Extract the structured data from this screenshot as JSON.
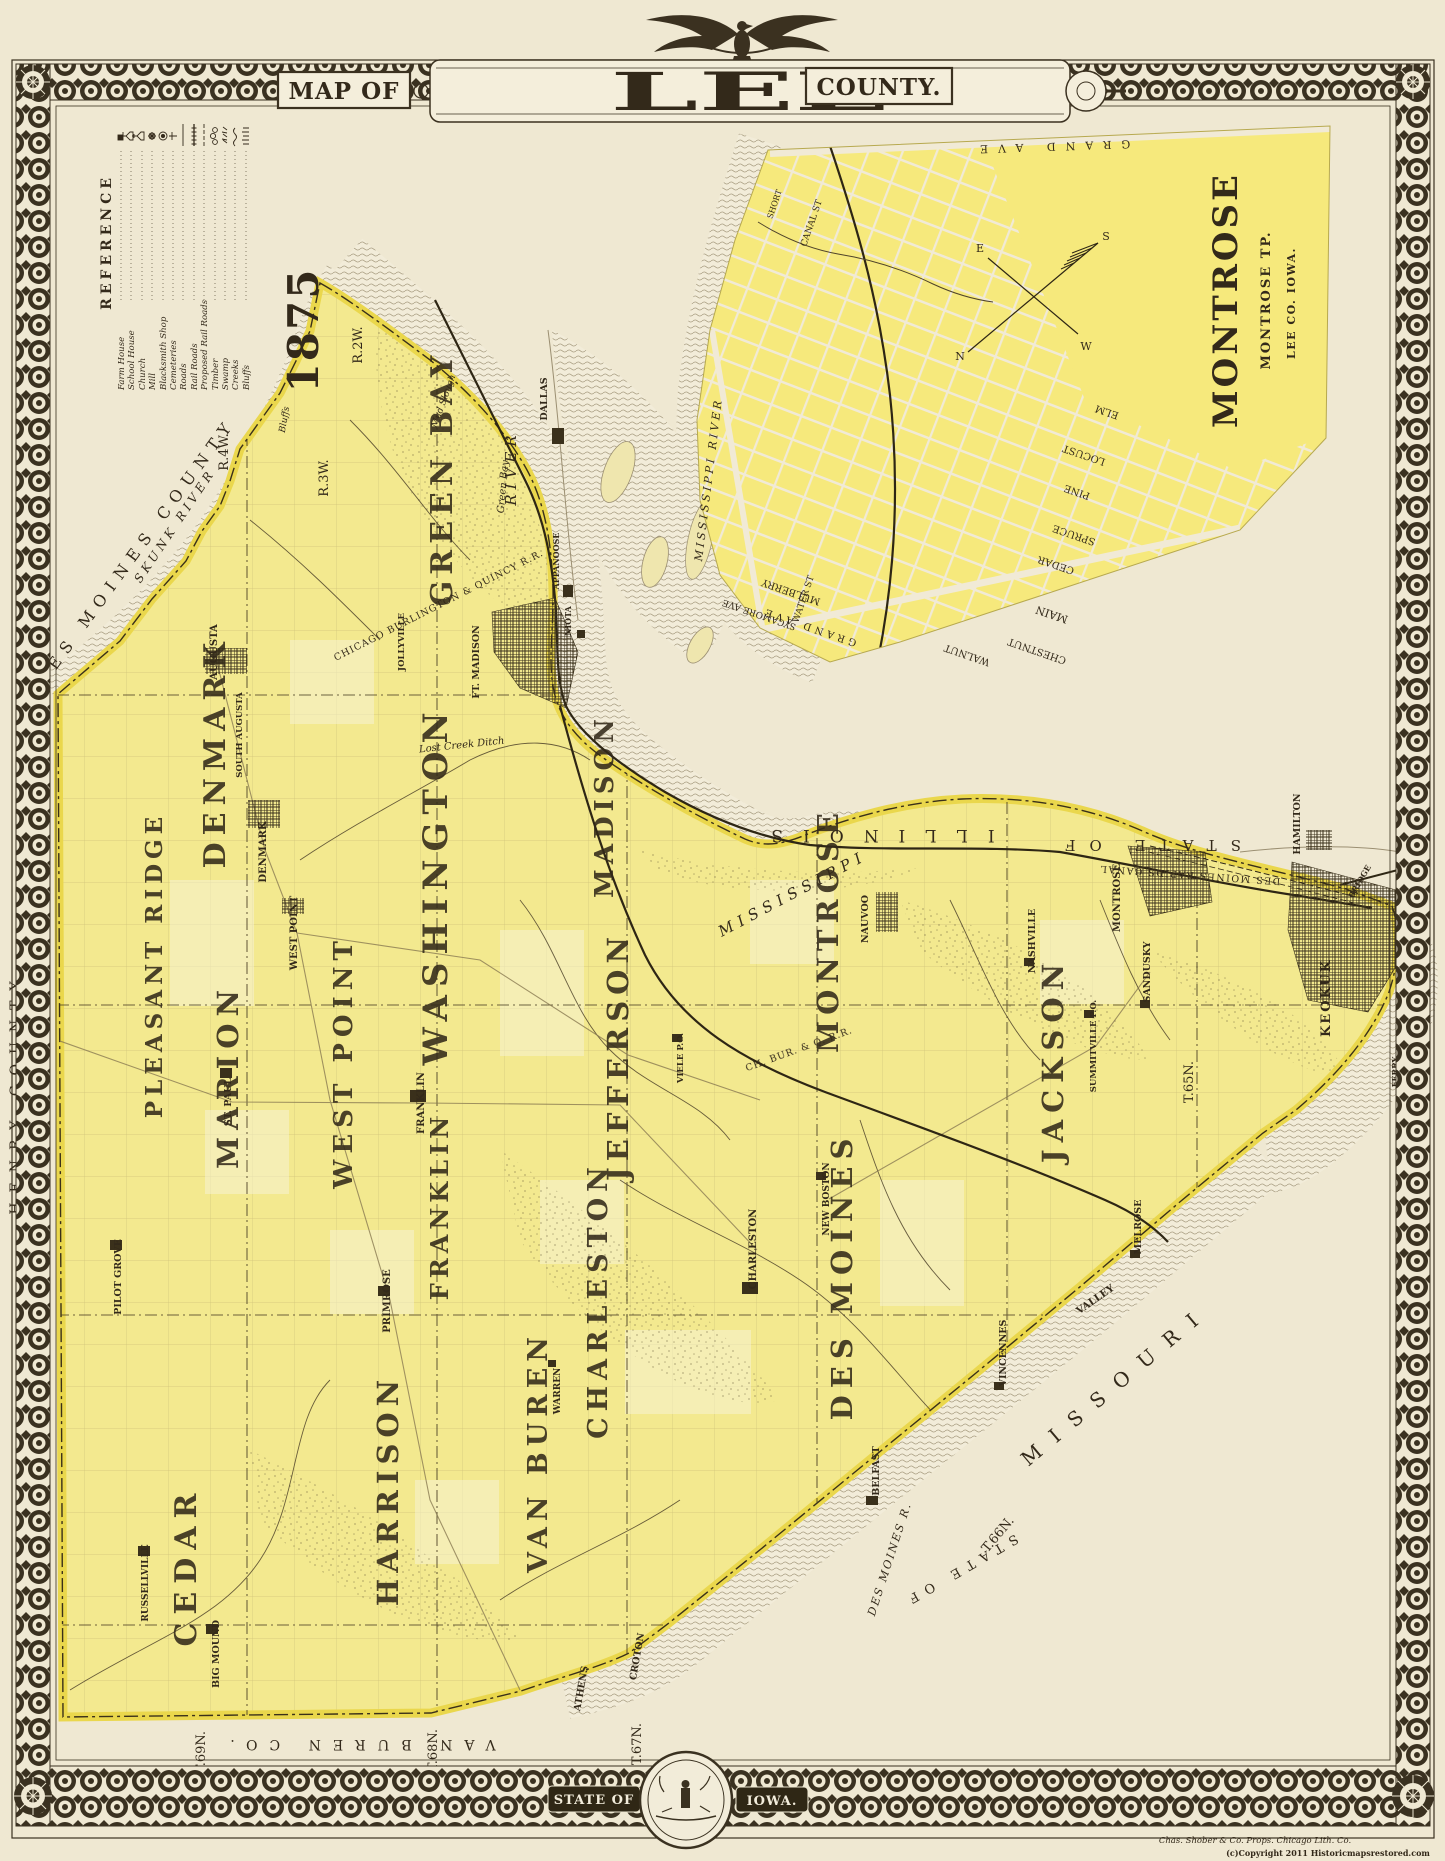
{
  "colors": {
    "paper": "#efe8d2",
    "county_yellow": "#f3e98f",
    "edge_yellow": "#ead74c",
    "inset_yellow": "#f6e97c",
    "ink": "#362d1b",
    "river_line": "#9b8f72"
  },
  "title": {
    "prefix": "MAP OF",
    "name": "LEE",
    "suffix": "COUNTY.",
    "year": "1875"
  },
  "reference": {
    "title": "REFERENCE",
    "items": [
      "Farm House",
      "School House",
      "Church",
      "Mill",
      "Blacksmith Shop",
      "Cemeteries",
      "Roads",
      "Rail Roads",
      "Proposed Rail Roads",
      "Timber",
      "Swamp",
      "Creeks",
      "Bluffs"
    ]
  },
  "inset": {
    "title": "MONTROSE",
    "tp": "MONTROSE TP.",
    "co": "LEE CO. IOWA.",
    "river": "MISSISSIPPI RIVER",
    "compass": {
      "n": "N",
      "s": "S",
      "e": "E",
      "w": "W"
    },
    "streets": [
      "GRAND AVE",
      "GRAND AVE",
      "ELM",
      "LOCUST",
      "PINE",
      "SPRUCE",
      "CEDAR",
      "MAIN",
      "CHESTNUT",
      "WALNUT",
      "MULBERRY",
      "SYCAMORE AVE",
      "WATER ST",
      "CANAL ST",
      "SHORT"
    ]
  },
  "map": {
    "townships": [
      "GREEN BAY",
      "WASHINGTON",
      "DENMARK",
      "MADISON",
      "PLEASANT RIDGE",
      "MARION",
      "WEST POINT",
      "JEFFERSON",
      "CEDAR",
      "FRANKLIN",
      "HARRISON",
      "CHARLESTON",
      "VAN BUREN",
      "DES MOINES",
      "MONTROSE",
      "JACKSON"
    ],
    "towns": [
      "AUGUSTA",
      "SOUTH AUGUSTA",
      "DENMARK",
      "JOLLYVILLE",
      "WEST POINT",
      "FRANKLIN",
      "CHARLESTON",
      "PRIMROSE",
      "RUSSELLVILLE",
      "BIG MOUND",
      "PILOT GROVE",
      "ST. PAUL",
      "VIELE P.O.",
      "MONTROSE",
      "SANDUSKY",
      "NASHVILLE",
      "SUMMITVILLE P.O.",
      "KEOKUK",
      "NEW BOSTON",
      "MELROSE",
      "VALLEY",
      "VINCENNES",
      "BELFAST",
      "CROTON",
      "ATHENS",
      "WARREN",
      "FT. MADISON",
      "DALLAS",
      "APPANOOSE",
      "NIOTA",
      "NAUVOO",
      "HAMILTON",
      "FERRY",
      "BRIDGE"
    ],
    "waters": [
      "MISSISSIPPI",
      "RIVER",
      "SKUNK RIVER",
      "DES MOINES R.",
      "DES MOINES RAPIDS CANAL",
      "Lost Creek Ditch",
      "Green Bay",
      "Mud Slough",
      "Bluffs"
    ],
    "neighbors": [
      "DES MOINES COUNTY",
      "HENRY COUNTY",
      "VAN BUREN CO.",
      "ILLINOIS",
      "STATE OF",
      "STATE OF",
      "MISSOURI"
    ],
    "ranges": [
      "R.2W.",
      "R.3W.",
      "R.4W.",
      "R.5W.",
      "R.6W.",
      "R.7W."
    ],
    "tiers": [
      "T.69N.",
      "T.68N.",
      "T.67N.",
      "T.66N.",
      "T.65N."
    ],
    "railroads": [
      "CHICAGO BURLINGTON & QUINCY R.R.",
      "CH. BUR. & Q. R.R."
    ]
  },
  "banner": {
    "left": "STATE OF",
    "right": "IOWA."
  },
  "credits": {
    "lith": "Chas. Shober & Co. Props. Chicago Lith. Co.",
    "copyright": "(c)Copyright 2011 Historicmapsrestored.com"
  }
}
